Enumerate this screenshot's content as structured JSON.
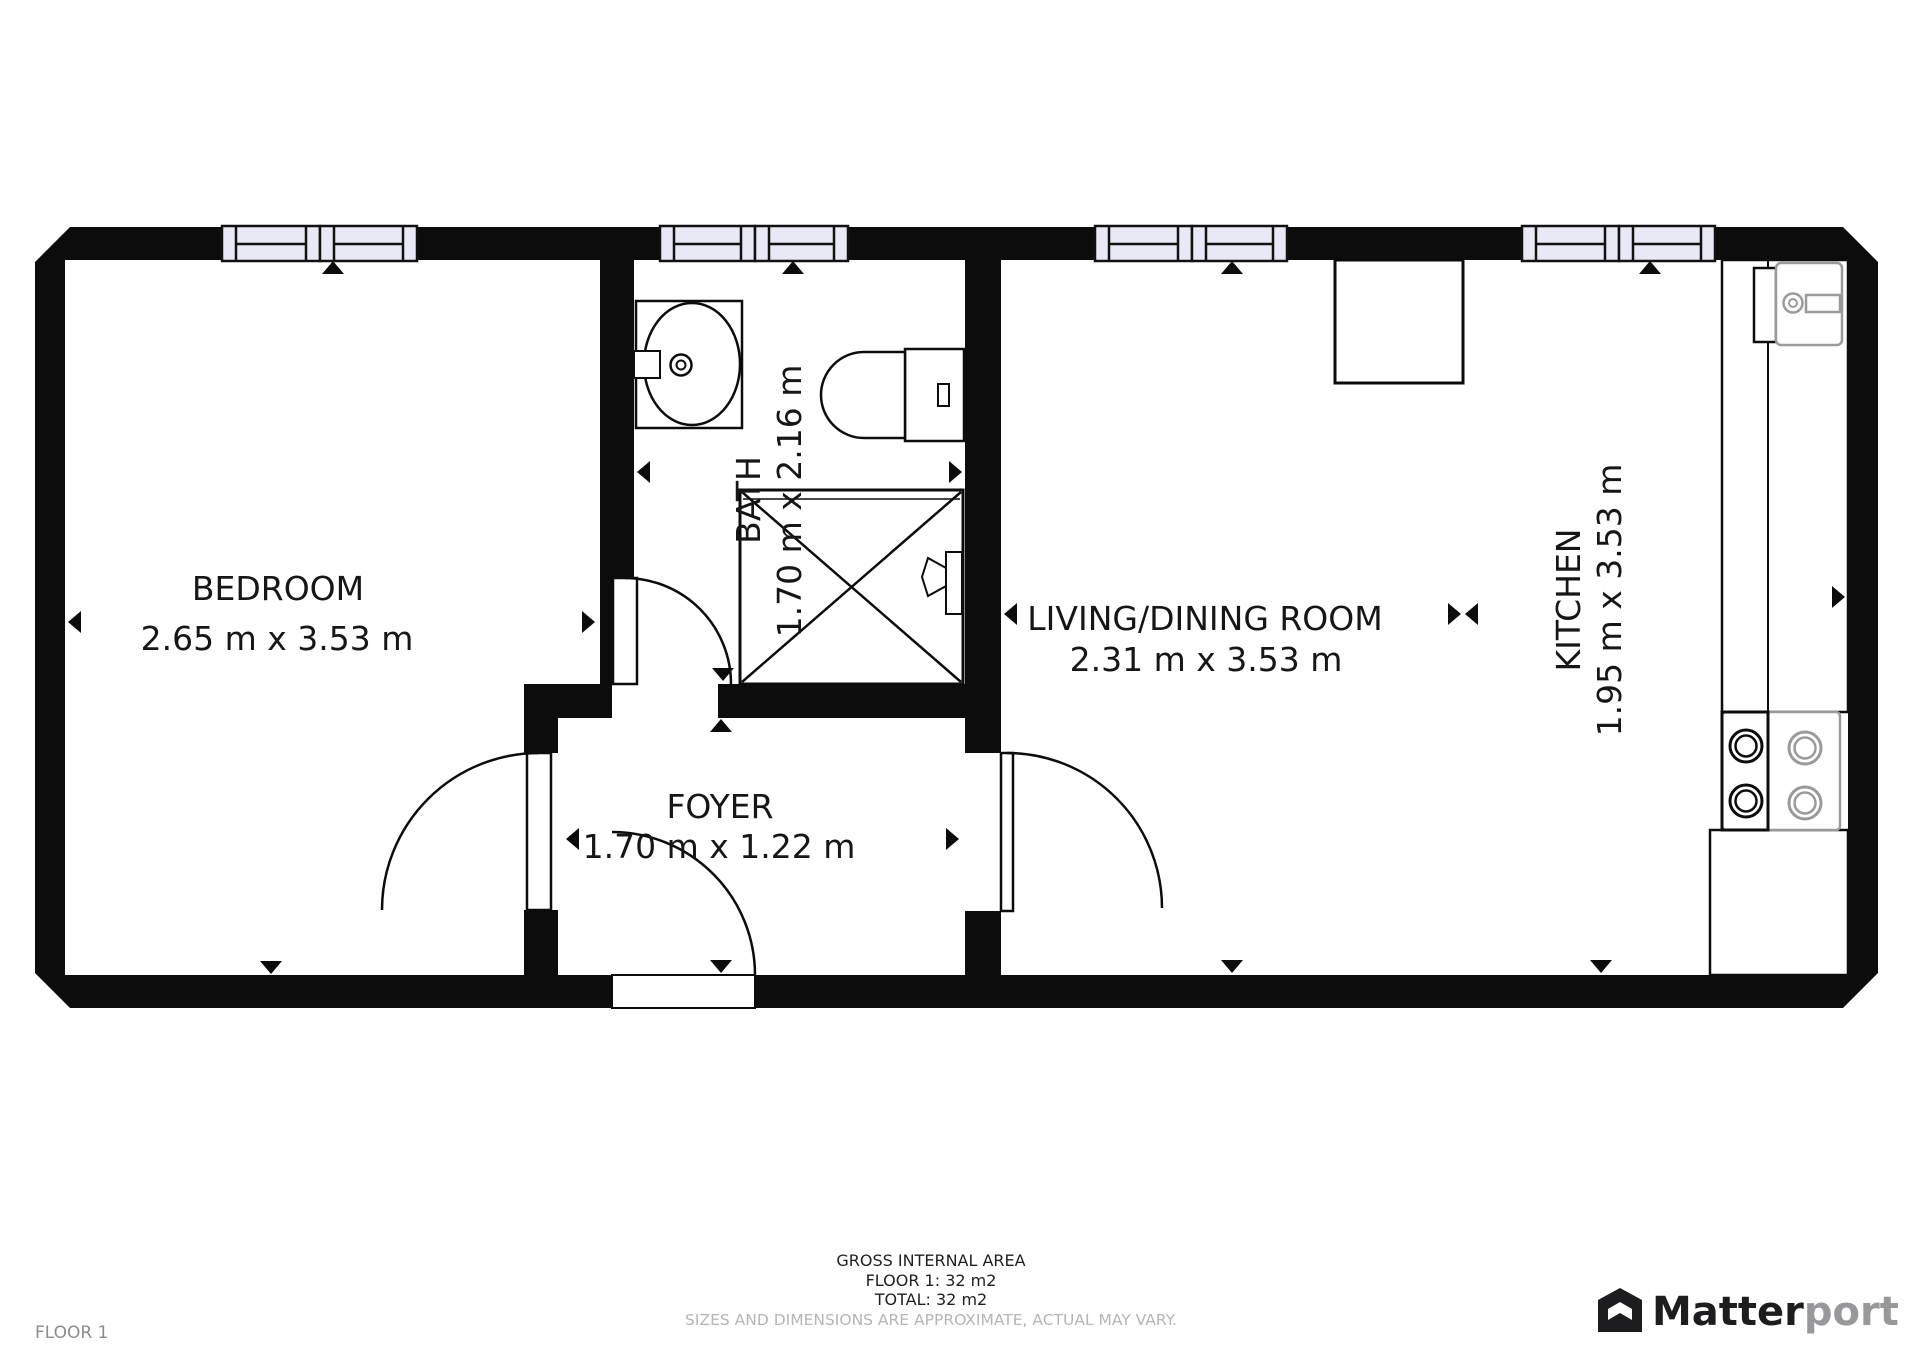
{
  "plan": {
    "floor_label": "FLOOR 1",
    "rooms": [
      {
        "name": "BEDROOM",
        "dims": "2.65 m x 3.53 m"
      },
      {
        "name": "BATH",
        "dims": "1.70 m x 2.16 m"
      },
      {
        "name": "FOYER",
        "dims": "1.70 m x 1.22 m"
      },
      {
        "name": "LIVING/DINING ROOM",
        "dims": "2.31 m x 3.53 m"
      },
      {
        "name": "KITCHEN",
        "dims": "1.95 m x 3.53 m"
      }
    ]
  },
  "footer": {
    "gross_internal_area": "GROSS INTERNAL AREA",
    "floor_area": "FLOOR 1: 32 m2",
    "total_area": "TOTAL: 32 m2",
    "disclaimer": "SIZES AND DIMENSIONS ARE APPROXIMATE, ACTUAL MAY VARY."
  },
  "branding": {
    "logo_primary": "Matter",
    "logo_secondary": "port"
  },
  "colors": {
    "wall": "#0c0c0c",
    "window_fill": "#e9e9f5",
    "fixture_gray": "#9a9a9a",
    "disclaimer_gray": "#b5b5b5",
    "floor_label_gray": "#8c8c8c",
    "logo_dark": "#1d1d1f",
    "logo_light": "#98989b"
  }
}
